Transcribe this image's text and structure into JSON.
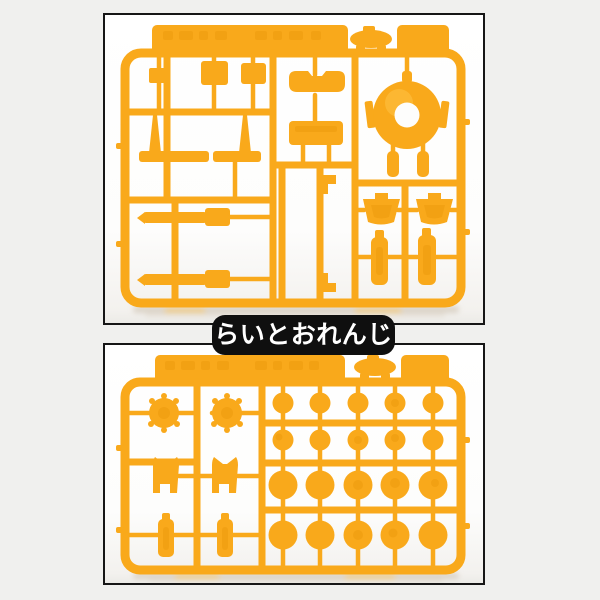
{
  "label": {
    "text": "らいとおれんじ"
  },
  "colors": {
    "page_bg": "#f0f0ee",
    "photo_border": "#161616",
    "label_bg": "#0f0f0f",
    "label_fg": "#ffffff",
    "sprue_base": "#F9A91B",
    "sprue_light": "#FFC54A",
    "sprue_dark": "#E18C00"
  },
  "photos": {
    "top": {
      "name": "runner-photo-1",
      "content": "yellow model-kit runner A with mixed parts and ring part"
    },
    "bottom": {
      "name": "runner-photo-2",
      "content": "yellow model-kit runner B with 4x5 grid of round parts"
    }
  }
}
